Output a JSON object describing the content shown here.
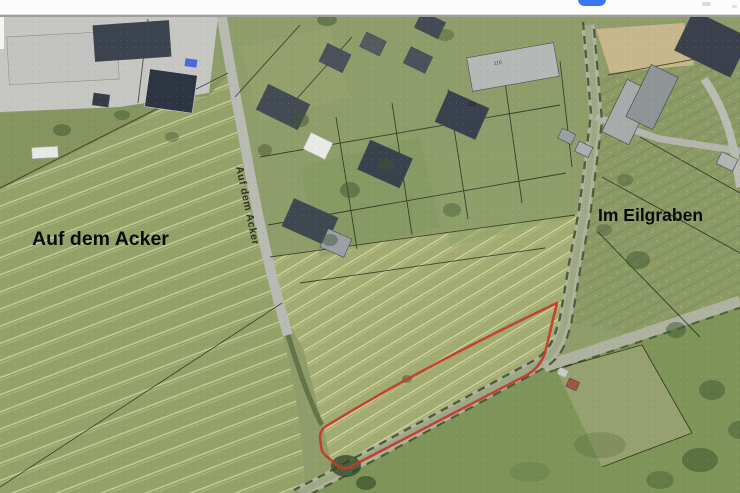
{
  "chrome": {
    "toolbar_button_color": "#3b76f2"
  },
  "map": {
    "type": "aerial-cadastral-photo",
    "labels": {
      "left_field": "Auf dem Acker",
      "street": "Auf dem Acker",
      "right_area": "Im Eilgraben",
      "house_number_a": "11b",
      "house_number_b": "110"
    },
    "highlight": {
      "outline_color": "#c23b2b"
    }
  }
}
